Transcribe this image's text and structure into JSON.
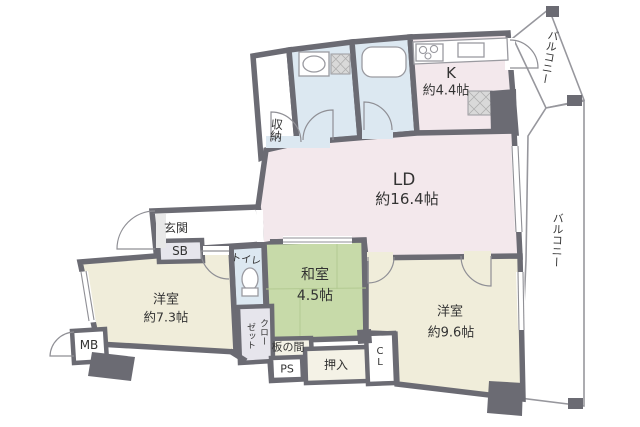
{
  "plan_title": "マンション間取り図",
  "rooms": {
    "ld": {
      "label": "LD",
      "size": "約16.4帖"
    },
    "kitchen": {
      "label": "K",
      "size": "約4.4帖"
    },
    "japanese_room": {
      "label": "和室",
      "size": "4.5帖"
    },
    "western_room_1": {
      "label": "洋室",
      "size": "約7.3帖"
    },
    "western_room_2": {
      "label": "洋室",
      "size": "約9.6帖"
    }
  },
  "labels": {
    "entrance": "玄関",
    "shoe_box": "SB",
    "toilet": "トイレ",
    "storage": "収納",
    "closet_line1": "クロー",
    "closet_line2": "ゼット",
    "wood_floor": "板の間",
    "pipe_space": "PS",
    "futon_closet": "押入",
    "closet_cl": "CL",
    "meter_box": "MB",
    "balcony_top": "バルコニー",
    "balcony_right": "バルコニー"
  },
  "colors": {
    "wall": "#6b6b73",
    "ld_pink": "#f3e8ec",
    "wet_blue": "#dce8f1",
    "tatami_green": "#c7daa9",
    "western_cream": "#f0edda",
    "closet_gray": "#e6e5ec",
    "wood_cream": "#f4f2e6",
    "white": "#ffffff"
  }
}
